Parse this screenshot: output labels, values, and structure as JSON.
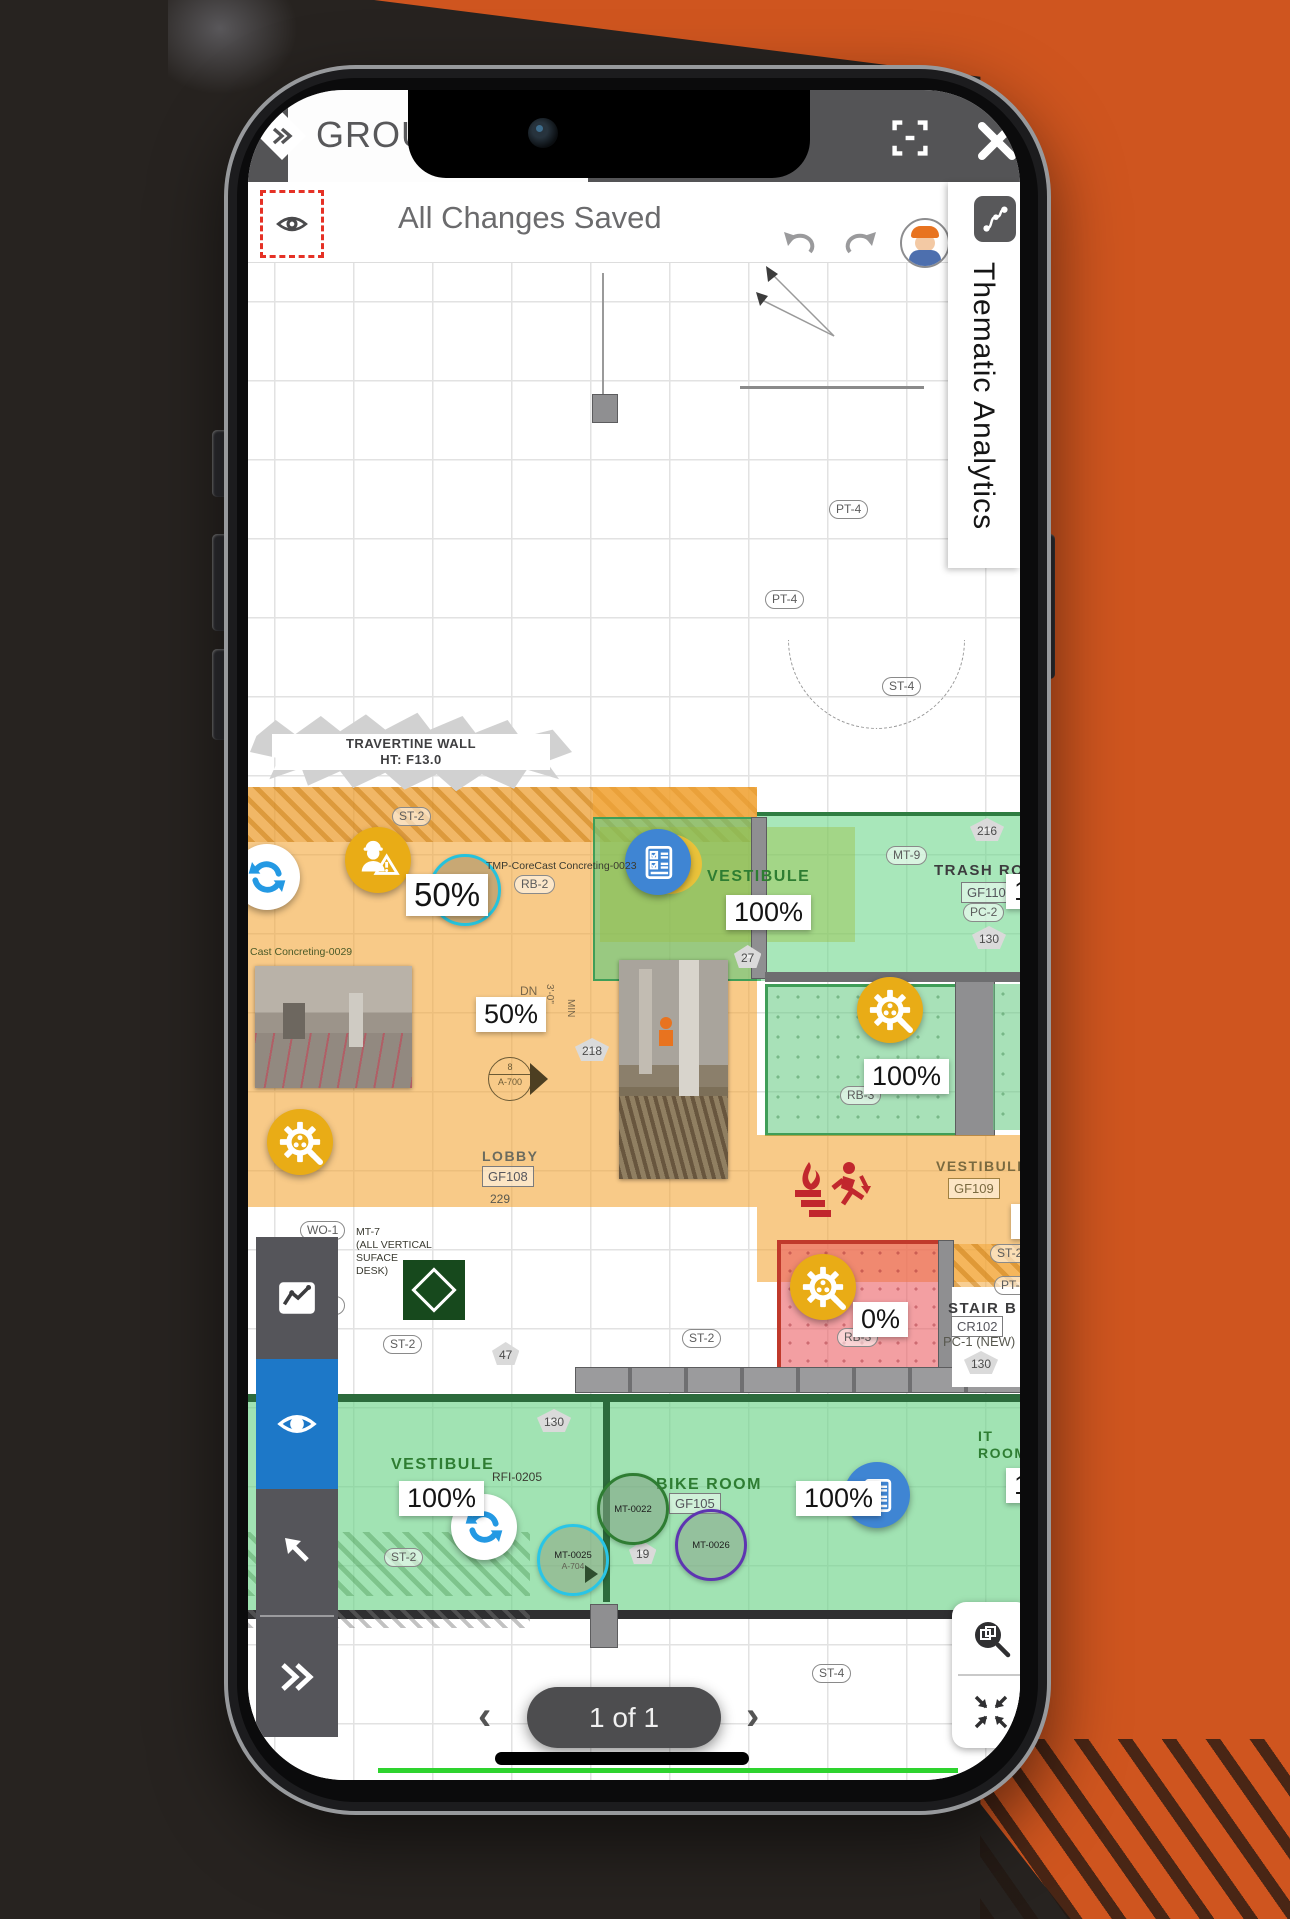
{
  "topbar": {
    "title": "GROUND",
    "menu_icon": "double-chevron-diamond",
    "fullscreen_icon": "fullscreen",
    "close_icon": "close"
  },
  "statusbar": {
    "text": "All Changes Saved",
    "eye_icon": "eye",
    "undo_icon": "undo",
    "redo_icon": "redo"
  },
  "thematic_panel": {
    "label": "Thematic Analytics",
    "icon": "route-polyline"
  },
  "sidebar": {
    "active_color": "#1d78c8",
    "items": [
      {
        "name": "analytics",
        "icon": "trend-chart-icon"
      },
      {
        "name": "visibility",
        "icon": "eye-icon",
        "active": true
      },
      {
        "name": "select",
        "icon": "arrow-up-left-icon"
      },
      {
        "name": "expand",
        "icon": "double-chevron-right-icon"
      }
    ]
  },
  "pager": {
    "label": "1 of 1",
    "prev": "‹",
    "next": "›"
  },
  "map_controls": [
    {
      "name": "zoom-region"
    },
    {
      "name": "fit-view"
    }
  ],
  "plan": {
    "callout": {
      "line1": "TRAVERTINE WALL",
      "line2": "HT: F13.0"
    },
    "rooms": [
      {
        "name": "VESTIBULE"
      },
      {
        "name": "TRASH ROOM"
      },
      {
        "name": "LOBBY"
      },
      {
        "name": "VESTIBULE"
      },
      {
        "name": "STAIR B"
      },
      {
        "name": "VESTIBULE"
      },
      {
        "name": "BIKE ROOM"
      },
      {
        "name": "IT ROOM"
      }
    ],
    "progress": [
      {
        "text": "50%"
      },
      {
        "text": "100%"
      },
      {
        "text": "100%"
      },
      {
        "text": "50%"
      },
      {
        "text": "100%"
      },
      {
        "text": "33%"
      },
      {
        "text": "0%"
      },
      {
        "text": "100%"
      },
      {
        "text": "100%"
      },
      {
        "text": "100%"
      }
    ],
    "chips": [
      {
        "text": "ST-2"
      },
      {
        "text": "RB-2"
      },
      {
        "text": "27"
      },
      {
        "text": "216"
      },
      {
        "text": "MT-9"
      },
      {
        "text": "GF110"
      },
      {
        "text": "PC-2"
      },
      {
        "text": "130"
      },
      {
        "text": "DN"
      },
      {
        "text": "3'-0\""
      },
      {
        "text": "MIN"
      },
      {
        "text": "218"
      },
      {
        "text": "229"
      },
      {
        "text": "WO-1"
      },
      {
        "text": "WO-1"
      },
      {
        "text": "ST-2"
      },
      {
        "text": "47"
      },
      {
        "text": "ST-2"
      },
      {
        "text": "ST-2"
      },
      {
        "text": "PT-16"
      },
      {
        "text": "130"
      },
      {
        "text": "RB-3"
      },
      {
        "text": "RB-3"
      },
      {
        "text": "130"
      },
      {
        "text": "ST-2"
      },
      {
        "text": "19"
      },
      {
        "text": "19"
      },
      {
        "text": "ST-4"
      },
      {
        "text": "ST-4"
      },
      {
        "text": "PT-4"
      },
      {
        "text": "PT-4"
      },
      {
        "text": "GF105"
      },
      {
        "text": "GF108"
      },
      {
        "text": "GF109"
      },
      {
        "text": "CR102"
      },
      {
        "text": "PC-1 (NEW)"
      }
    ],
    "notes": {
      "corecast23": "TMP-CoreCast Concreting-0023",
      "corecast29": "Cast Concreting-0029",
      "rfi": "RFI-0205",
      "mt7": [
        "MT-7",
        "(ALL VERTICAL",
        "SUFACE",
        "DESK)"
      ],
      "a700": {
        "top": "8",
        "bottom": "A-700"
      },
      "a704": "A-704"
    },
    "markers": {
      "mt0022": "MT-0022",
      "mt0023": "MT-0023",
      "mt0025": "MT-0025",
      "mt0026": "MT-0026"
    }
  },
  "colors": {
    "accent_blue": "#1d78c8",
    "marker_gold": "#e9ac16",
    "sync_blue": "#2499e3",
    "checklist_blue": "#3f85d3",
    "overlay_orange": "#f3a638",
    "overlay_green": "#60c87d",
    "overlay_red": "#eb5a5f",
    "background_orange": "#cf551f"
  }
}
